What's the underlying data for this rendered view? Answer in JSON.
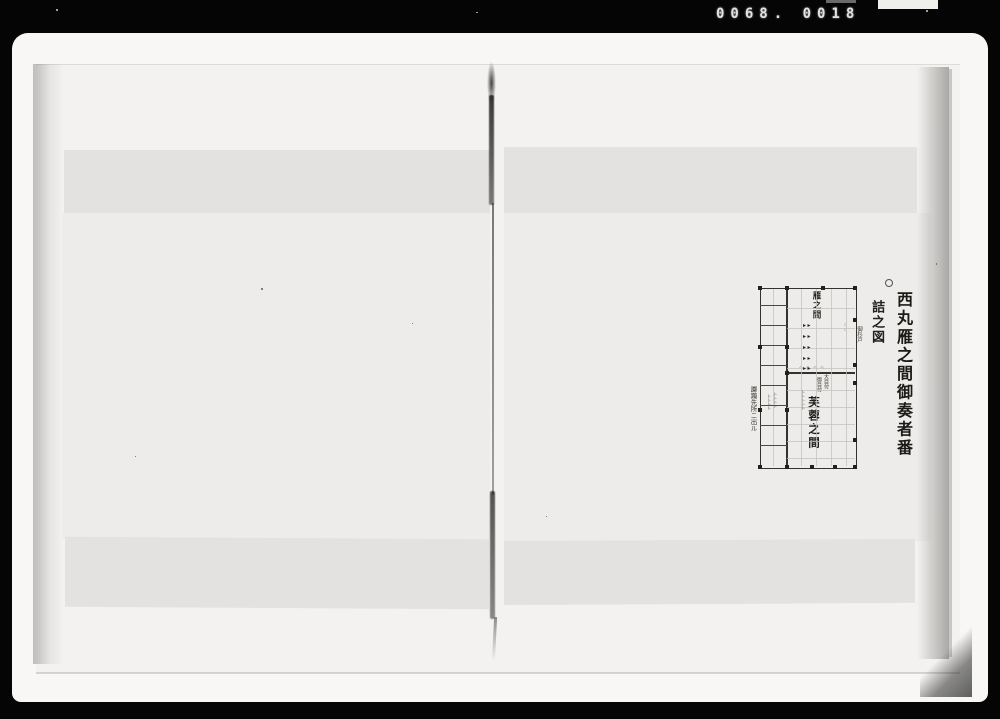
{
  "microfilm": {
    "frame_number": "0068. 0018"
  },
  "page": {
    "marker": "○",
    "title": "西丸雁之間御奏者番",
    "subtitle": "詰之図",
    "plan": {
      "room_upper": "雁之間",
      "room_lower": "芙蓉之間",
      "official_right": "大目付",
      "official_left": "御目付",
      "note_right": "御杉戸",
      "note_left": "躑躅先所ニ出ル",
      "seat_rows": [
        "▸▸",
        "▸▸",
        "▸▸",
        "▸▸",
        "▸▸"
      ],
      "cushion_marks": "へへへへ",
      "faint_marks": "くく",
      "tick_columns": [
        "卜卜卜卜",
        "卜卜卜卜",
        "卜卜卜卜卜"
      ]
    }
  },
  "colors": {
    "film_background": "#050505",
    "print_paper": "#f8f7f5",
    "page_paper": "#edecea",
    "page_underlay": "#e3e2e0",
    "ink": "#34322e"
  }
}
